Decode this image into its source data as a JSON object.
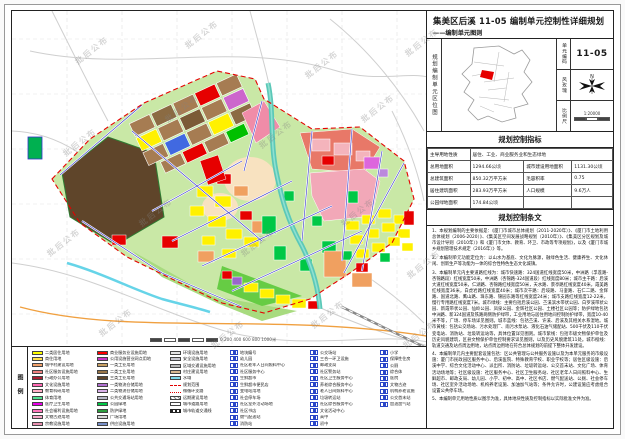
{
  "title": {
    "main": "集美区后溪 11-05 编制单元控制性详细规划",
    "sub": "——编制单元图则"
  },
  "location_panel": {
    "side_label": "规划编制单元区位图",
    "unit_code_label": "单元编码",
    "unit_code": "11-05",
    "wind_rose_label": "风玫瑰",
    "scale_label": "比例尺",
    "scale_text": "1:20000"
  },
  "indicators": {
    "header": "规划控制指标",
    "rows": [
      {
        "label": "主导用地性质",
        "value": "居住、工业、商业服务业和生态绿地"
      },
      {
        "label": "总用地面积",
        "value": "1294.66公顷",
        "label2": "城市建设用地面积",
        "value2": "1131.30公顷"
      },
      {
        "label": "总建筑面积",
        "value": "850.32万平方米",
        "label2": "毛容积率",
        "value2": "0.75"
      },
      {
        "label": "居住建筑面积",
        "value": "283.93万平方米",
        "label2": "人口规模",
        "value2": "9.6万人"
      },
      {
        "label": "公园绿地面积",
        "value": "174.84公顷",
        "label2": "",
        "value2": ""
      }
    ]
  },
  "provisions": {
    "header": "规划控制条文",
    "items": [
      "1、本规划编制的主要依据是：《厦门市城市总体规划（2011-2020年）》、《厦门市土地利用总体规划（2006-2020）》、《集美区空间发展战略规划（2010年）》、《集美区分区规划及城市设计导则（2010年）》和《厦门市文体、教育、环卫、市政等专项规划》，以及《厦门市城乡规划管理技术规定（2016年）》等。",
      "2、本编制单元功能定位为：以山水为基底、文化为脉源，融绿色生活、健康养生、文化休闲、创新生产等功能为一体的综合性特色生态文化城镇。",
      "3、本编制单元内主要道路红线为：城市快速路：324国道红线宽度50米，中洲路（孚莲路-杏锦路段）红线宽度50米，中洲路（杏锦路-324国道段）红线宽度80米；城市主干路：后溪大道红线宽度50米，仁湖路、杏锦路红线宽度50米，天水路、景亭路红线宽度40米，霞美路红线宽度36米，白虎岩路红线宽度40米；城市次干路：后垵路、马銮路、石仁二路、金辉路、国道北路、鹰山路、珠东路、锦园东路等红线宽度24米；城市支路红线宽度12-22米，慢行专用路红线宽度7米。城市绿线：主要包括后溪公园、苎溪滨水带状公园、白罗溪带状公园、新霞带状公园、仙岭公园、凤泉公园、金辉社区公园、土楼社区公园等；防护绿地包括中洲路、新324国道及铁路两侧防护绿带，工业用地与居住用地间控制防护绿带，宽度10-40米不等，广场、停车场详见图则。城市蓝线：包括苎溪、许溪、后溪及其相关水系湿地。城市黄线：包括公交场站、污水处理厂、雨污水泵站、液化石油气储配站、500千伏及110千伏变电站、消防站、垃圾转运站等，具体位置详见图则。城市紫线：包括市级文物保护单位及历史风貌建筑，区县文物保护单位控制要求详见图则，以及历史风貌建筑11处。城市橙线：轨道交通及站点周边用地，站点周边用地在符合总体规划的前提下整体开发建设。",
      "4、本编制单元内主要配套设施包括：区公共管理与公共服务设施以及为本单元服务的市级设施：厦门市民政园区服务中心、后溪医院、特殊教育学校、职业学校等；居住区级设施：后溪中学、综合文化活动中心、派出所、消防站、垃圾转运站、公交首末站、文化广场、体育活动场地等；社区级设施：社区服务中心、社区卫生服务站、社区老年人日间照料中心、生鲜超市、邮政支局、幼儿园、小学、初中、高中、社区书店、燃气配送站、公厕、社会停车场、社区室外活动场地、机构养老设施、加油加气站等；条件允许时，公建设施应考虑组合设置公共停车场。",
      "5、本编制单元用地性质以图示为准，具体地块性质及控制指标以实际批准文件为准。"
    ]
  },
  "legend": {
    "side_label": "图例",
    "columns": [
      [
        {
          "c": "#FFFF00",
          "t": "二类居住用地"
        },
        {
          "c": "#FFE14D",
          "t": "商住用地"
        },
        {
          "c": "#F2A16B",
          "t": "城中村建设用地"
        },
        {
          "c": "#F08080",
          "t": "社区服务设施用地"
        },
        {
          "c": "#AA1E32",
          "t": "行政办公用地"
        },
        {
          "c": "#FF69B4",
          "t": "文化设施用地"
        },
        {
          "c": "#FFB0C8",
          "t": "教育科研用地"
        },
        {
          "c": "#50E090",
          "t": "体育用地"
        },
        {
          "c": "#E800E8",
          "t": "医疗卫生用地"
        },
        {
          "c": "#FF77BB",
          "t": "社会福利设施用地"
        },
        {
          "c": "#F8A8C8",
          "t": "文物古迹用地"
        },
        {
          "c": "#E890B0",
          "t": "宗教设施用地"
        }
      ],
      [
        {
          "c": "#FF0000",
          "t": "商业服务业设施用地"
        },
        {
          "c": "#C838C8",
          "t": "公用设施营业网点用地"
        },
        {
          "c": "#C8A064",
          "t": "一类工业用地"
        },
        {
          "c": "#9A7648",
          "t": "二类工业用地"
        },
        {
          "c": "#5F452A",
          "t": "三类工业用地"
        },
        {
          "c": "#B070D0",
          "t": "一类物流仓储用地"
        },
        {
          "c": "#D8B0E8",
          "t": "二类物流仓储用地"
        },
        {
          "c": "#B8B8C8",
          "t": "公共交通场站用地"
        },
        {
          "c": "#00C846",
          "t": "公园绿地"
        },
        {
          "c": "#2E9E3E",
          "t": "防护绿地"
        },
        {
          "c": "#D8D8D8",
          "t": "广场用地"
        },
        {
          "c": "#7890C8",
          "t": "供应设施用地"
        }
      ],
      [
        {
          "c": "#E4E4E4",
          "t": "环境设施用地"
        },
        {
          "c": "#C8C8D0",
          "t": "安全设施用地"
        },
        {
          "c": "#B8B8B8",
          "t": "区域交通设施用地"
        },
        {
          "c": "#D8B890",
          "t": "村庄建设用地"
        },
        {
          "c": "#7FD9EA",
          "t": "水域"
        },
        {
          "c": "dash-red",
          "t": "规划范围"
        },
        {
          "c": "dot-red",
          "t": "微循环支路"
        },
        {
          "c": "hatch",
          "t": "远期建设用地"
        },
        {
          "c": "white",
          "t": "城市道路用地"
        },
        {
          "c": "rail",
          "t": "城市轨道交通线"
        }
      ],
      [
        {
          "c": "icon",
          "t": "地块编号"
        },
        {
          "c": "icon",
          "t": "幼儿园"
        },
        {
          "c": "icon",
          "t": "社区老年人日间照料中心"
        },
        {
          "c": "icon",
          "t": "社区服务中心"
        },
        {
          "c": "icon",
          "t": "生鲜超市"
        },
        {
          "c": "icon",
          "t": "生鲜超市便民店"
        },
        {
          "c": "icon",
          "t": "变电站用地"
        },
        {
          "c": "icon",
          "t": "社会停车场"
        },
        {
          "c": "icon",
          "t": "社区室外活动场地"
        },
        {
          "c": "icon",
          "t": "社区书店"
        },
        {
          "c": "icon",
          "t": "燃气配送站"
        },
        {
          "c": "icon",
          "t": "消防站"
        }
      ],
      [
        {
          "c": "icon",
          "t": "公交场站"
        },
        {
          "c": "icon",
          "t": "三合一环卫设施"
        },
        {
          "c": "icon",
          "t": "邮政支局"
        },
        {
          "c": "icon",
          "t": "社区警务站"
        },
        {
          "c": "icon",
          "t": "社区卫生服务中心"
        },
        {
          "c": "icon",
          "t": "养老综合服务中心"
        },
        {
          "c": "icon",
          "t": "老人日间照料中心"
        },
        {
          "c": "icon",
          "t": "垃圾转运站"
        },
        {
          "c": "icon",
          "t": "社区综合服务中心"
        },
        {
          "c": "icon",
          "t": "文化活动中心"
        },
        {
          "c": "icon",
          "t": "高中"
        },
        {
          "c": "icon",
          "t": "初中"
        }
      ],
      [
        {
          "c": "icon",
          "t": "小学"
        },
        {
          "c": "icon",
          "t": "保障性住房"
        },
        {
          "c": "icon",
          "t": "公厕"
        },
        {
          "c": "icon",
          "t": "综合体"
        },
        {
          "c": "icon",
          "t": "医院"
        },
        {
          "c": "icon",
          "t": "文物古迹"
        },
        {
          "c": "icon",
          "t": "机构养老设施"
        },
        {
          "c": "icon",
          "t": "公交首末站"
        },
        {
          "c": "icon",
          "t": "加油加气站"
        }
      ]
    ]
  },
  "map": {
    "watermark": "批后公布",
    "scalebar_label": "0  200  400  600  800  1000米",
    "north_label": "N"
  }
}
